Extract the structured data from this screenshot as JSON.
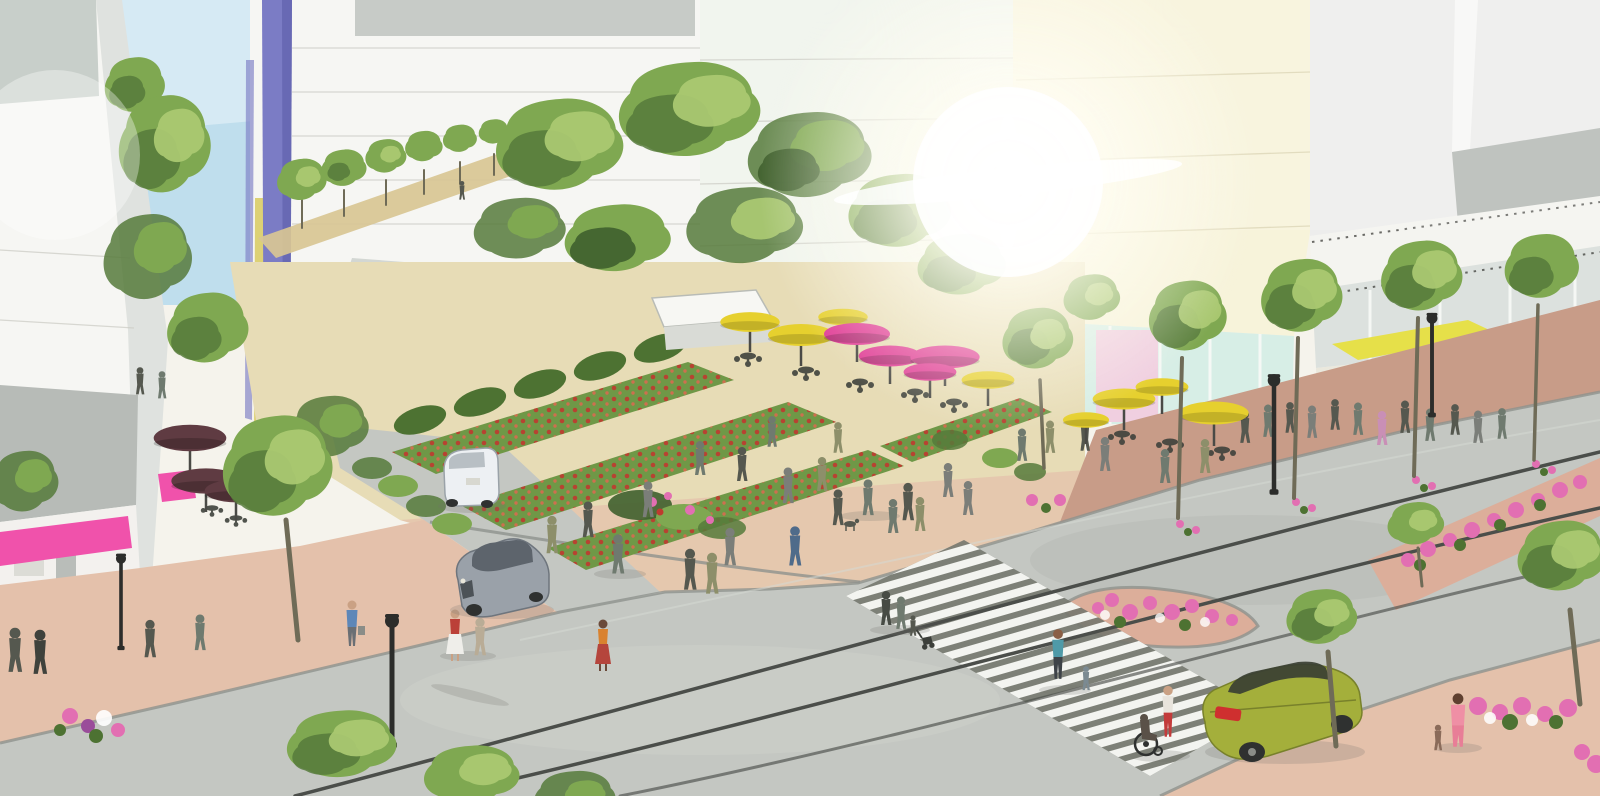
{
  "canvas": {
    "width": 1600,
    "height": 796
  },
  "scene": {
    "type": "architectural-rendering",
    "style": "watercolor-sketch",
    "subject": "aerial view of an urban corner plaza and street intersection",
    "objects": {
      "vehicles": [
        "white minivan parked",
        "silver sedan",
        "olive-green sedan near crosswalk"
      ],
      "umbrella_colors": [
        "yellow",
        "magenta-pink",
        "dark maroon"
      ],
      "awning_colors": [
        "pink",
        "orange",
        "yellow",
        "teal"
      ],
      "features": [
        "corner plaza with rows of red flower beds",
        "sidewalk cafe tables and umbrellas",
        "zebra crosswalk with pedestrians",
        "streetcar rails in roadway",
        "tree-lined sidewalks and median planters with pink flowers",
        "street lamps",
        "pedestrians including wheelchair user, stroller and children",
        "office buildings with purple banner and glass storefronts",
        "sun flare at building corner"
      ]
    }
  },
  "palette": {
    "sky": "#bfdeed",
    "bldg_white": "#f6f6f3",
    "bldg_gray_panel": "#b7bbb7",
    "bldg_gray_light": "#dfe2df",
    "bldg_ivory": "#f7f3da",
    "bldg_right_face": "#ededec",
    "banner_purple": "#7b7cc5",
    "banner_yellow": "#d8ca5e",
    "glass_teal": "#d7eee6",
    "glass_gray": "#dce1de",
    "door_pink": "#f0cfe0",
    "path_tan": "#d8c594",
    "plaza_tan": "#e7dcb6",
    "sidewalk_pink": "#e4c1ab",
    "sidewalk_brick": "#c89c88",
    "median_brick": "#dcae9a",
    "road_gray": "#c4c7c2",
    "road_dark": "#b3b7b2",
    "curb_gray": "#8f928d",
    "rail_dark": "#4b4e4a",
    "crosswalk_base": "#75786f",
    "crosswalk_white": "#f3f4f0",
    "umbrella_yellow": "#e6d02e",
    "umbrella_magenta": "#e03e97",
    "umbrella_maroon": "#5f3b42",
    "awning_pink": "#f052ab",
    "awning_orange": "#d8882c",
    "awning_yellow": "#e6e049",
    "awning_teal": "#41ad8b",
    "flower_red": "#bf3a2f",
    "flower_pink": "#e26fb2",
    "garden_green": "#6f9847",
    "garden_dark": "#4d7232",
    "car_white": "#edf0f3",
    "car_silver": "#9aa1a9",
    "car_silver_dark": "#5d646c",
    "car_green": "#a4af3b",
    "tail_red": "#cf2f2f",
    "wheel_dark": "#2f3130",
    "lamp_black": "#2c2d2b",
    "person_gray": "#7b7e79"
  }
}
